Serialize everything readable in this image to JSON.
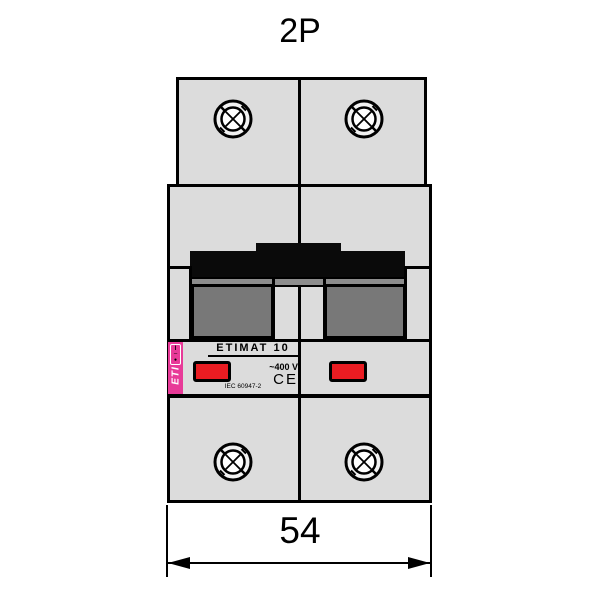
{
  "title": "2P",
  "device": {
    "brand": "ETI",
    "model": "ETIMAT 10",
    "voltage": "~400 V",
    "ce_mark": "CE",
    "standard": "IEC 60947-2",
    "switch_marks": {
      "on": "I",
      "dash": "–",
      "off": "●"
    }
  },
  "dimension": {
    "width_mm": "54"
  },
  "icons": {
    "screw_terminal": "screw-head-crosshatch",
    "dimension_arrow": "double-headed-arrow"
  },
  "colors": {
    "body-fill": "#dcdcdc",
    "line": "#000000",
    "toggle-black": "#0a0a0a",
    "chamber-gray": "#787878",
    "strip-gray": "#8d8d8d",
    "brand-pink": "#e83a98",
    "indicator-red": "#ea1c22"
  }
}
